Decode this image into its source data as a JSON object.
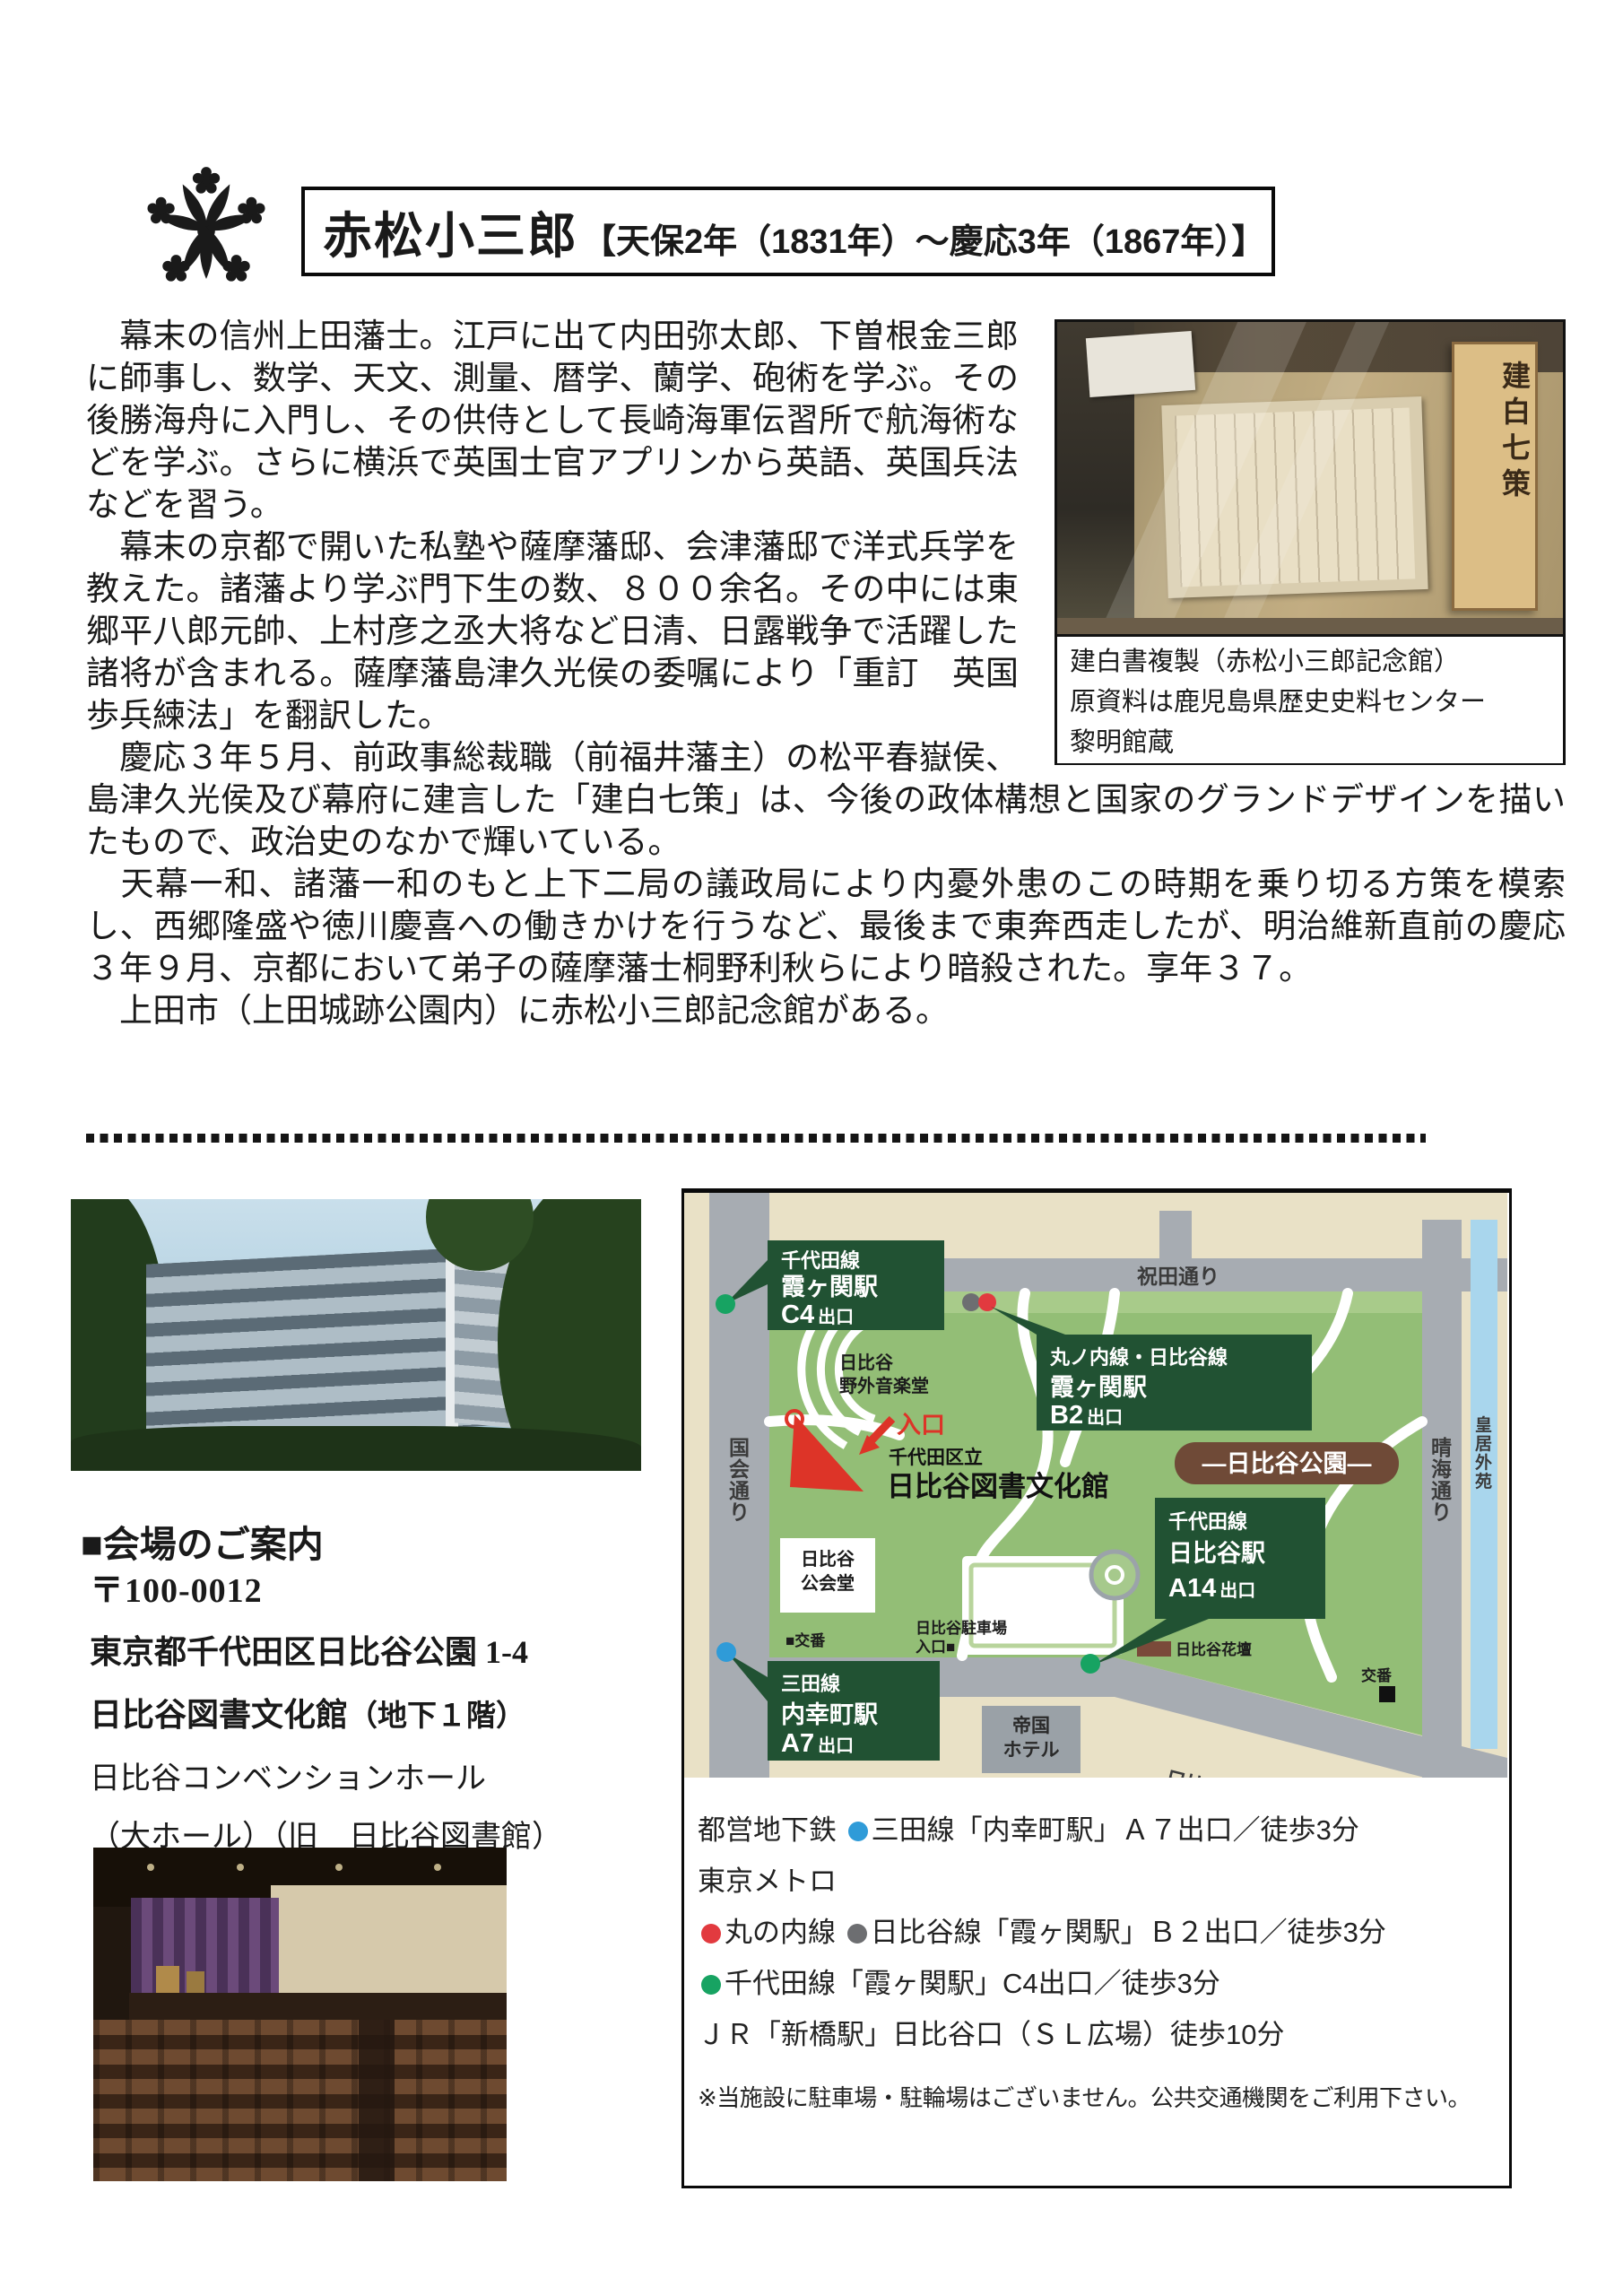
{
  "header": {
    "name": "赤松小三郎",
    "dates": "【天保2年（1831年）～慶応3年（1867年）】",
    "crest_icon": "kamon-flower-crest"
  },
  "bio": {
    "paragraphs": [
      "　幕末の信州上田藩士。江戸に出て内田弥太郎、下曽根金三郎に師事し、数学、天文、測量、暦学、蘭学、砲術を学ぶ。その後勝海舟に入門し、その供侍として長崎海軍伝習所で航海術などを学ぶ。さらに横浜で英国士官アプリンから英語、英国兵法などを習う。",
      "　幕末の京都で開いた私塾や薩摩藩邸、会津藩邸で洋式兵学を教えた。諸藩より学ぶ門下生の数、８００余名。その中には東郷平八郎元帥、上村彦之丞大将など日清、日露戦争で活躍した諸将が含まれる。薩摩藩島津久光侯の委嘱により「重訂　英国歩兵練法」を翻訳した。",
      "　慶応３年５月、前政事総裁職（前福井藩主）の松平春嶽侯、島津久光侯及び幕府に建言した「建白七策」は、今後の政体構想と国家のグランドデザインを描いたもので、政治史のなかで輝いている。",
      "　天幕一和、諸藩一和のもと上下二局の議政局により内憂外患のこの時期を乗り切る方策を模索し、西郷隆盛や徳川慶喜への働きかけを行うなど、最後まで東奔西走したが、明治維新直前の慶応３年９月、京都において弟子の薩摩藩士桐野利秋らにより暗殺された。享年３７。",
      "　上田市（上田城跡公園内）に赤松小三郎記念館がある。"
    ]
  },
  "artifact": {
    "plank_text": "建白七策",
    "caption_lines": [
      "建白書複製（赤松小三郎記念館）",
      "原資料は鹿児島県歴史史料センター",
      "黎明館蔵"
    ]
  },
  "venue": {
    "heading": "■会場のご案内",
    "postal": "〒100-0012",
    "address": "東京都千代田区日比谷公園 1-4",
    "building_main": "日比谷図書文化館",
    "building_note": "（地下１階）",
    "hall": "日比谷コンベンションホール",
    "hall_note": "（大ホール）（旧　日比谷図書館）"
  },
  "map": {
    "streets": {
      "north": "祝田通り",
      "west": "国会通り",
      "east": "晴海通り",
      "south": "日比谷通り",
      "palace": "皇居外苑"
    },
    "park_badge": "―日比谷公園―",
    "stations": [
      {
        "line": "千代田線",
        "station": "霞ヶ関駅",
        "exit": "C4",
        "exit_suffix": "出口",
        "marker_color": "#17a362"
      },
      {
        "line": "丸ノ内線・日比谷線",
        "station": "霞ヶ関駅",
        "exit": "B2",
        "exit_suffix": "出口",
        "marker_color": "#e23a3f",
        "marker2_color": "#6d6e71"
      },
      {
        "line": "千代田線",
        "station": "日比谷駅",
        "exit": "A14",
        "exit_suffix": "出口",
        "marker_color": "#17a362"
      },
      {
        "line": "三田線",
        "station": "内幸町駅",
        "exit": "A7",
        "exit_suffix": "出口",
        "marker_color": "#2f9bd8"
      }
    ],
    "pois": {
      "ongakudo": [
        "日比谷",
        "野外音楽堂"
      ],
      "entrance": "入口",
      "library_muni": "千代田区立",
      "library_name": "日比谷図書文化館",
      "kokaido": [
        "日比谷",
        "公会堂"
      ],
      "koban_left": "■交番",
      "parking": [
        "日比谷駐車場",
        "入口■"
      ],
      "imperial_hotel": [
        "帝国",
        "ホテル"
      ],
      "kadan": "日比谷花壇",
      "koban_right": "交番"
    },
    "colors": {
      "base": "#e9e1c6",
      "road": "#a7acb2",
      "park": "#93be76",
      "water": "#a9d6ed",
      "station_label_bg": "#215233",
      "park_badge_bg": "#6f4a37",
      "entrance_red": "#dd3428"
    }
  },
  "access": {
    "rows": [
      {
        "segments": [
          {
            "t": "都営地下鉄 "
          },
          {
            "d": "#2f9bd8"
          },
          {
            "t": "三田線「内幸町駅」Ａ７出口／徒歩3分"
          }
        ]
      },
      {
        "segments": [
          {
            "t": "東京メトロ"
          }
        ]
      },
      {
        "segments": [
          {
            "d": "#e23a3f"
          },
          {
            "t": "丸の内線 "
          },
          {
            "d": "#6d6e71"
          },
          {
            "t": "日比谷線「霞ヶ関駅」Ｂ２出口／徒歩3分"
          }
        ]
      },
      {
        "segments": [
          {
            "d": "#17a362"
          },
          {
            "t": "千代田線「霞ヶ関駅」C4出口／徒歩3分"
          }
        ]
      },
      {
        "segments": [
          {
            "t": "ＪＲ「新橋駅」日比谷口（ＳＬ広場）徒歩10分"
          }
        ]
      }
    ],
    "note": "※当施設に駐車場・駐輪場はございません。公共交通機関をご利用下さい。"
  }
}
